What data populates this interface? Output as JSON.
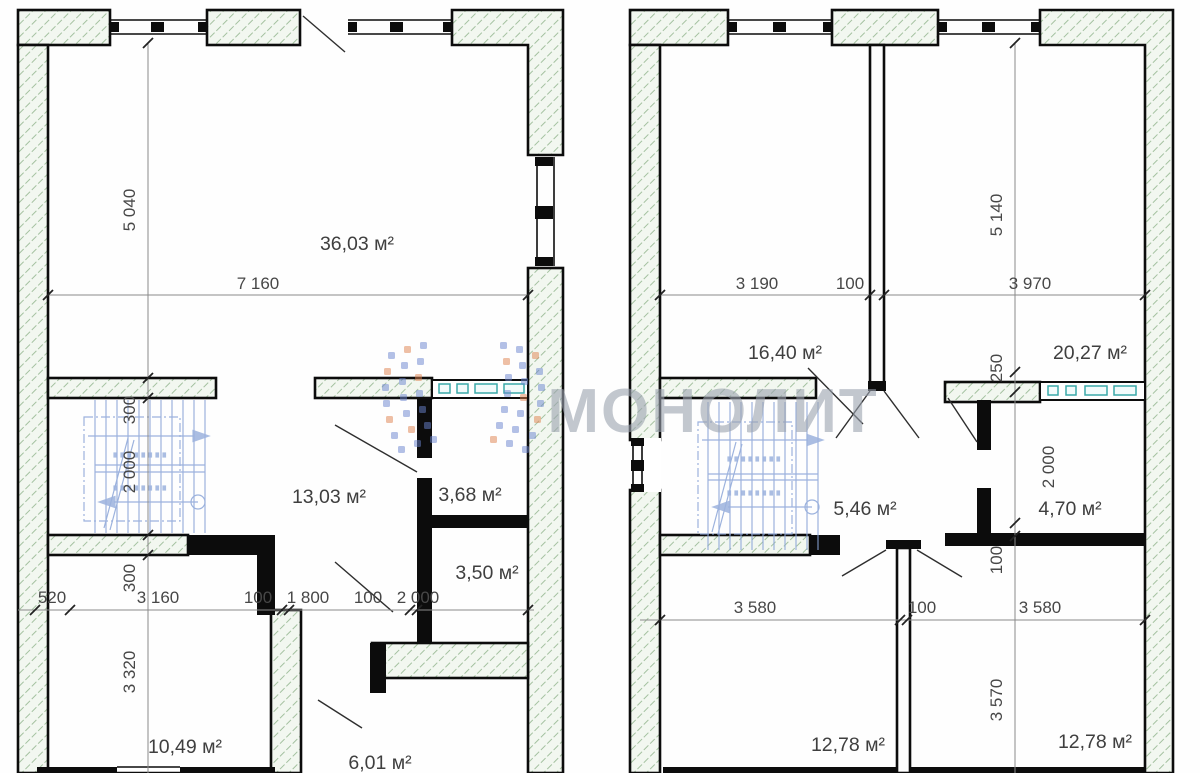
{
  "watermark": {
    "text": "МОНОЛИТ"
  },
  "colors": {
    "hatch_line": "#a4c1a0",
    "wall_fill": "#f2f7f0",
    "stair_blue": "#8ba5d8",
    "fixture_teal": "#3aa9a9",
    "watermark_gray": "#9ba3af",
    "logo_blue": "#6b84cf",
    "logo_orange": "#e0824f"
  },
  "plans": {
    "left": {
      "room_areas": [
        "36,03 м²",
        "13,03 м²",
        "3,68 м²",
        "3,50 м²",
        "10,49 м²",
        "6,01 м²"
      ],
      "dim_width_top": "7 160",
      "dims_left_column": [
        "5 040",
        "300",
        "2 000",
        "300",
        "3 320"
      ],
      "dims_middle_row": [
        "520",
        "3 160",
        "100",
        "1 800",
        "100",
        "2 000"
      ]
    },
    "right": {
      "room_areas": [
        "16,40 м²",
        "20,27 м²",
        "5,46 м²",
        "4,70 м²",
        "12,78 м²",
        "12,78 м²"
      ],
      "dims_top_row": [
        "3 190",
        "100",
        "3 970"
      ],
      "dims_right_column": [
        "5 140",
        "250",
        "2 000",
        "100",
        "3 570"
      ],
      "dims_middle_row": [
        "3 580",
        "100",
        "3 580"
      ]
    }
  }
}
